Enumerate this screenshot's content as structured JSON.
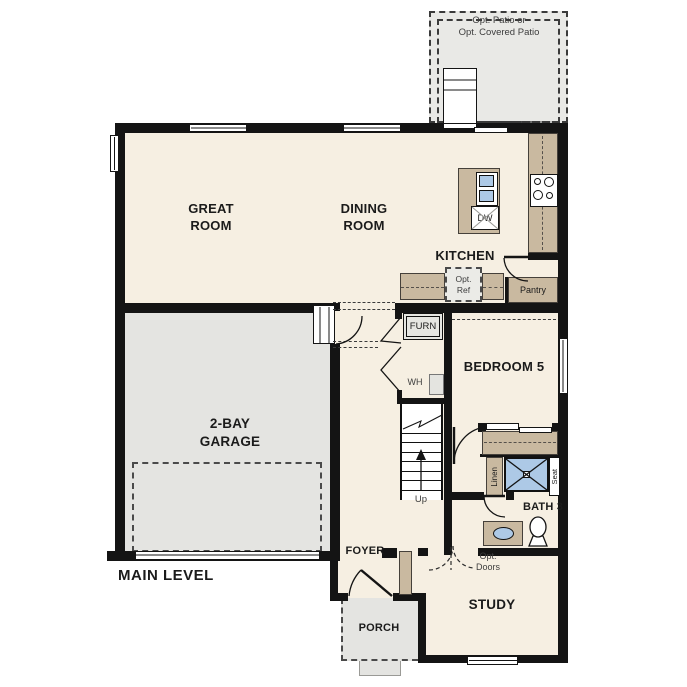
{
  "plan": {
    "title": "MAIN LEVEL",
    "colors": {
      "wall": "#141414",
      "floor": "#f6efe2",
      "garage": "#e4e4e1",
      "patio": "#e9e9e6",
      "tan": "#c9b9a0",
      "blue": "#adc9e6",
      "dash": "#3a3a3a",
      "text": "#1b1b1b",
      "note": "#3d3d3d"
    },
    "labels": {
      "patio": "Opt. Patio or\nOpt. Covered Patio",
      "great_room": "GREAT\nROOM",
      "dining_room": "DINING\nROOM",
      "kitchen": "KITCHEN",
      "garage": "2-BAY\nGARAGE",
      "bedroom5": "BEDROOM 5",
      "bath3": "BATH 3",
      "study": "STUDY",
      "foyer": "FOYER",
      "porch": "PORCH",
      "pantry": "Pantry",
      "opt_ref": "Opt.\nRef",
      "opt_doors": "Opt.\nDoors",
      "furnace": "FURN",
      "water_heater": "WH",
      "dishwasher": "DW",
      "linen": "Linen",
      "seat": "Seat",
      "stairs_up": "Up",
      "level": "MAIN LEVEL"
    }
  }
}
